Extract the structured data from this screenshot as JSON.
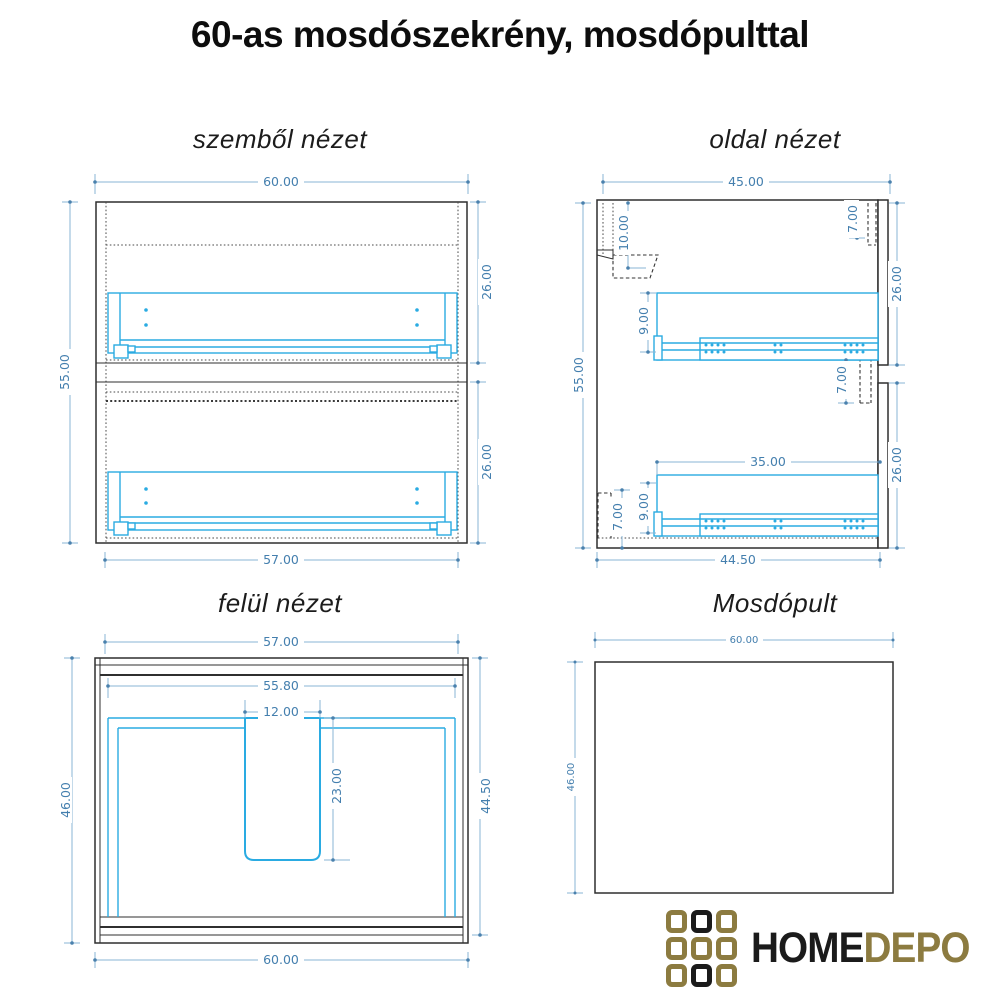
{
  "title": "60-as mosdószekrény, mosdópulttal",
  "views": {
    "front": {
      "title": "szemből nézet",
      "dims": {
        "overall_width": "60.00",
        "overall_height": "55.00",
        "top_drawer_front": "26.00",
        "bottom_drawer_front": "26.00",
        "carcass_width": "57.00"
      }
    },
    "side": {
      "title": "oldal nézet",
      "dims": {
        "overall_depth": "45.00",
        "overall_height": "55.00",
        "back_rail": "10.00",
        "top_overhang": "7.00",
        "top_drawer_front": "26.00",
        "mid_overlap": "7.00",
        "slide_length": "35.00",
        "slide_offset_top": "9.00",
        "slide_offset_bottom": "9.00",
        "plinth": "7.00",
        "bottom_drawer_front": "26.00",
        "carcass_depth": "44.50"
      }
    },
    "top": {
      "title": "felül nézet",
      "dims": {
        "carcass_width": "57.00",
        "inner_width": "55.80",
        "cutout_width": "12.00",
        "cutout_depth": "23.00",
        "overall_depth": "46.00",
        "carcass_depth": "44.50",
        "overall_width": "60.00"
      }
    },
    "counter": {
      "title": "Mosdópult",
      "dims": {
        "width": "60.00",
        "depth": "46.00"
      }
    }
  },
  "logo": {
    "text_primary": "HOME",
    "text_secondary": "DEPO",
    "grid": [
      "gold",
      "black",
      "gold",
      "gold",
      "gold",
      "gold",
      "gold",
      "black",
      "gold"
    ],
    "gold_color": "#8c7b40",
    "black_color": "#1b1b1b"
  },
  "colors": {
    "dimension_text": "#447fae",
    "dimension_line": "#8ab6d6",
    "drawing_accent": "#2aabe2",
    "outline": "#2f2f2f"
  }
}
